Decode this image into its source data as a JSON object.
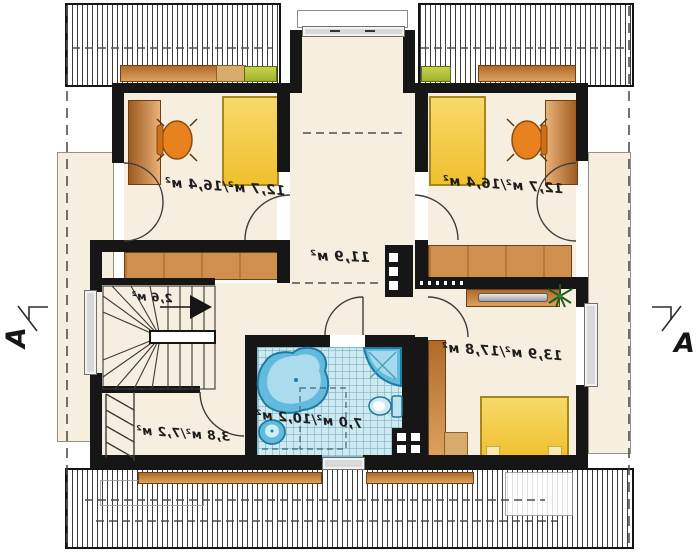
{
  "plan": {
    "type": "floor-plan",
    "floor": "attic",
    "text_direction": "mirrored",
    "rooms": [
      {
        "name": "bedroom-top-left",
        "area_label": "12,7 м²/16,4 м²"
      },
      {
        "name": "bedroom-top-right",
        "area_label": "12,7 м²/16,4 м²"
      },
      {
        "name": "hall",
        "area_label": "11,9 м²"
      },
      {
        "name": "staircase",
        "area_label": "2,6 м²"
      },
      {
        "name": "bathroom",
        "area_label": "7,0 м²/10,2 м²"
      },
      {
        "name": "bedroom-bottom-right",
        "area_label": "13,9 м²/17,8 м²"
      },
      {
        "name": "wardrobe",
        "area_label": "3,8 м²/7,2 м²"
      }
    ],
    "section_markers": {
      "left_label": "A",
      "right_label": "A"
    },
    "colors": {
      "floor_cream": "#f6efdf",
      "wall_black": "#161616",
      "furniture_brown": "#c98648",
      "bed_yellow": "#f2c52f",
      "chair_orange": "#e8821e",
      "accent_green": "#a9bc37",
      "bath_tile_blue": "#cfe9f1",
      "fixture_blue": "#45aacd",
      "wood_tan": "#d29a55"
    }
  }
}
